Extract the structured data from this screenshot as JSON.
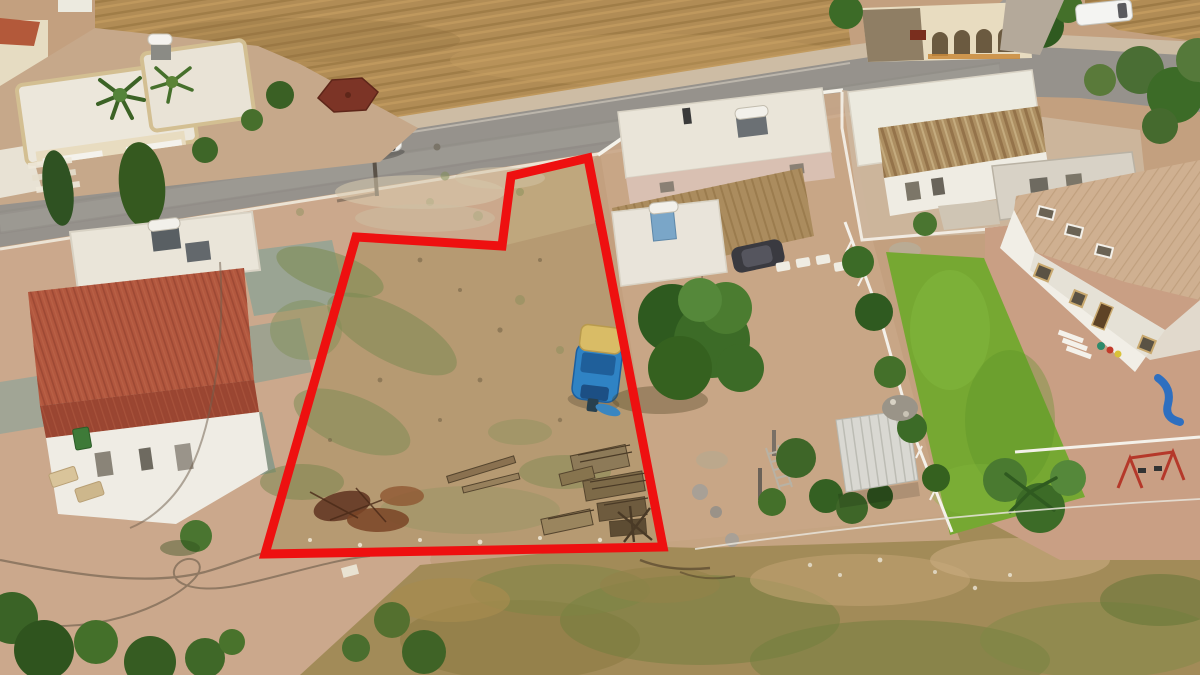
{
  "image": {
    "kind": "aerial drone photograph",
    "subject": "vacant residential land plot outlined in red among village houses and a diagonal street",
    "width_px": 1200,
    "height_px": 675,
    "visible_text": []
  },
  "annotation": {
    "label": "plot boundary",
    "shape": "polygon",
    "points": "588,158 511,176 502,246 356,237 265,554 663,547",
    "stroke": "#ee1010",
    "stroke_width": 9
  },
  "palette": {
    "base_dirt": "#c3a07f",
    "plot_dirt": "#b69a72",
    "outside_dirt": "#c9a687",
    "bottom_dirt": "#cba88c",
    "scrub": "#a28b58",
    "field": "#b18c55",
    "road": "#96928c",
    "road_shoulder": "#cdbca4",
    "lawn": "#76a832",
    "tree_dark": "#3c6b27",
    "red_roof": "#b2573e",
    "tile_roof": "#cfb091",
    "carport_roof": "#ab8c5e",
    "rust_roof": "#ad8f62",
    "white_roof": "#eae5d9",
    "cream_wall": "#e8dcc0",
    "pink_wall": "#d9c0b2",
    "gazebo_roof": "#7c3426",
    "shed_roof": "#d9d8d2",
    "pavement": "#c99f84",
    "boat_hull": "#2f83c4",
    "boat_canopy": "#d9bc66",
    "boundary_red": "#ee1010"
  },
  "scene": {
    "objects": [
      "asphalt street running diagonally with junction at right",
      "harvested hay field with furrow rows",
      "white SUV driving on street",
      "utility pole with shadow",
      "vacant plot of bare earth with green weed patches",
      "blue boat with tan canopy parked on plot",
      "stacked wooden pallets on plot",
      "burnt branch pile on plot",
      "cream villa with palm trees and solar water heater",
      "dark red garden gazebo",
      "white outbuilding with red corrugated roof and solar water heater",
      "pink house with flat white roof and brown carport",
      "dark car parked under carport",
      "white house with rusted metal awning near junction",
      "stone house with arched veranda at top",
      "white van parked at top right",
      "two-storey house with beige tiled roof at right",
      "bright green lawn",
      "white metal garden shed among bushes",
      "palm trees along white boundary fence",
      "red swing frame and blue slide in play corner",
      "garden hoses on bare yard",
      "overhead cable crossing foreground",
      "dry scrub grass in foreground",
      "green shrubs in bottom-left corner"
    ]
  }
}
